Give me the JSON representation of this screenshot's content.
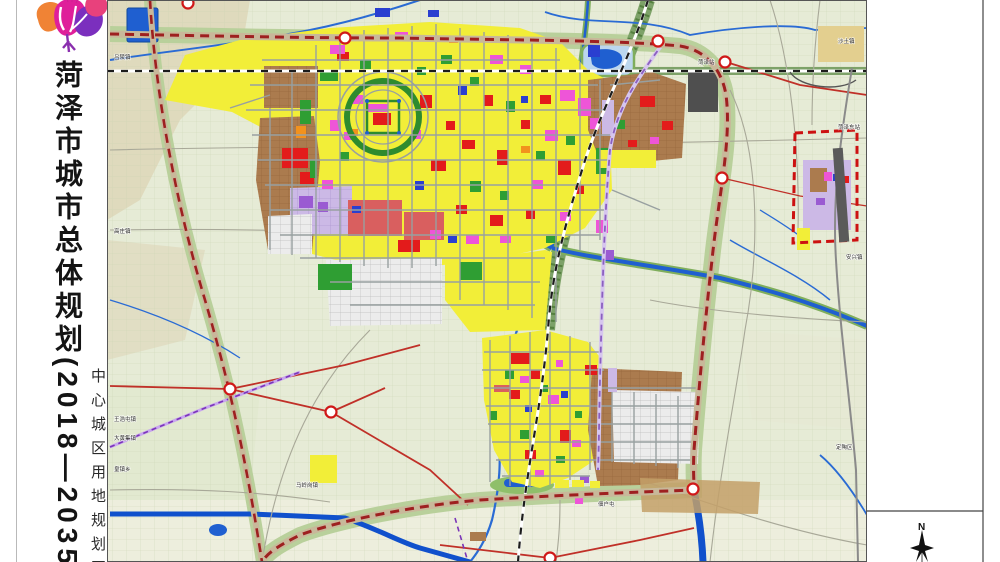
{
  "sidebar": {
    "title": "菏泽市城市总体规划(2018—2035年)",
    "subtitle": "中心城区用地规划图"
  },
  "compass": {
    "north_label": "N"
  },
  "map": {
    "palette": {
      "y": "#f2ee38",
      "r": "#e31b1b",
      "m": "#ee55d8",
      "g": "#2f9e33",
      "b": "#2a3fd0",
      "o": "#f2921d",
      "p": "#9a5bd2",
      "lv": "#ccb9e6",
      "br": "#ab7b4e",
      "dr": "#d95f5f",
      "tn": "#e3cf8f",
      "dg": "#4f4f4f",
      "water": "#1f5fd0",
      "background_field": "#e6ebd6",
      "greenbelt": "#b9d09b",
      "boundary_dash": "#c01414",
      "expressway_dash": "#9e2020",
      "rail_corridor": "#6f9c55"
    },
    "labels": [
      {
        "x": 114,
        "y": 59,
        "t": "吕陵镇"
      },
      {
        "x": 114,
        "y": 233,
        "t": "高庄镇"
      },
      {
        "x": 114,
        "y": 421,
        "t": "王浩屯镇"
      },
      {
        "x": 114,
        "y": 440,
        "t": "大黄集镇"
      },
      {
        "x": 114,
        "y": 471,
        "t": "皇镇乡"
      },
      {
        "x": 296,
        "y": 487,
        "t": "马岭岗镇"
      },
      {
        "x": 698,
        "y": 64,
        "t": "菏泽站"
      },
      {
        "x": 838,
        "y": 129,
        "t": "菏泽东站"
      },
      {
        "x": 838,
        "y": 43,
        "t": "沙土镇"
      },
      {
        "x": 846,
        "y": 259,
        "t": "安兴镇"
      },
      {
        "x": 836,
        "y": 449,
        "t": "定陶区"
      },
      {
        "x": 598,
        "y": 506,
        "t": "佃户屯"
      }
    ],
    "parcels": [
      [
        282,
        148,
        26,
        20,
        "r"
      ],
      [
        300,
        172,
        14,
        12,
        "r"
      ],
      [
        337,
        52,
        12,
        9,
        "r"
      ],
      [
        420,
        95,
        12,
        13,
        "r"
      ],
      [
        446,
        121,
        9,
        9,
        "r"
      ],
      [
        462,
        140,
        13,
        9,
        "r"
      ],
      [
        484,
        95,
        9,
        11,
        "r"
      ],
      [
        497,
        150,
        11,
        15,
        "r"
      ],
      [
        521,
        120,
        9,
        9,
        "r"
      ],
      [
        540,
        95,
        11,
        9,
        "r"
      ],
      [
        431,
        160,
        15,
        11,
        "r"
      ],
      [
        456,
        205,
        11,
        9,
        "r"
      ],
      [
        490,
        215,
        13,
        11,
        "r"
      ],
      [
        526,
        210,
        9,
        9,
        "r"
      ],
      [
        558,
        160,
        13,
        15,
        "r"
      ],
      [
        575,
        185,
        9,
        9,
        "r"
      ],
      [
        373,
        113,
        18,
        12,
        "r"
      ],
      [
        398,
        240,
        22,
        12,
        "r"
      ],
      [
        348,
        200,
        54,
        36,
        "dr"
      ],
      [
        404,
        212,
        40,
        28,
        "dr"
      ],
      [
        330,
        45,
        15,
        9,
        "m"
      ],
      [
        395,
        32,
        13,
        9,
        "m"
      ],
      [
        352,
        95,
        11,
        9,
        "m"
      ],
      [
        330,
        120,
        11,
        11,
        "m"
      ],
      [
        412,
        130,
        9,
        9,
        "m"
      ],
      [
        368,
        104,
        20,
        8,
        "m"
      ],
      [
        322,
        180,
        11,
        9,
        "m"
      ],
      [
        430,
        230,
        11,
        9,
        "m"
      ],
      [
        466,
        235,
        13,
        9,
        "m"
      ],
      [
        500,
        236,
        11,
        7,
        "m"
      ],
      [
        560,
        90,
        15,
        11,
        "m"
      ],
      [
        578,
        98,
        13,
        18,
        "m"
      ],
      [
        590,
        118,
        11,
        11,
        "m"
      ],
      [
        545,
        130,
        13,
        11,
        "m"
      ],
      [
        520,
        65,
        11,
        9,
        "m"
      ],
      [
        490,
        55,
        13,
        9,
        "m"
      ],
      [
        532,
        180,
        11,
        9,
        "m"
      ],
      [
        560,
        212,
        11,
        9,
        "m"
      ],
      [
        596,
        220,
        12,
        13,
        "m"
      ],
      [
        344,
        132,
        10,
        8,
        "m"
      ],
      [
        320,
        70,
        18,
        11,
        "g"
      ],
      [
        360,
        60,
        11,
        9,
        "g"
      ],
      [
        300,
        100,
        11,
        24,
        "g"
      ],
      [
        340,
        152,
        9,
        9,
        "g"
      ],
      [
        441,
        55,
        11,
        9,
        "g"
      ],
      [
        470,
        77,
        9,
        9,
        "g"
      ],
      [
        506,
        101,
        9,
        11,
        "g"
      ],
      [
        536,
        151,
        9,
        9,
        "g"
      ],
      [
        566,
        136,
        9,
        9,
        "g"
      ],
      [
        470,
        181,
        11,
        11,
        "g"
      ],
      [
        500,
        191,
        9,
        9,
        "g"
      ],
      [
        546,
        236,
        11,
        7,
        "g"
      ],
      [
        310,
        160,
        7,
        18,
        "g"
      ],
      [
        596,
        148,
        13,
        26,
        "g"
      ],
      [
        417,
        67,
        9,
        8,
        "g"
      ],
      [
        318,
        264,
        34,
        26,
        "g"
      ],
      [
        460,
        262,
        22,
        18,
        "g"
      ],
      [
        375,
        8,
        15,
        9,
        "b"
      ],
      [
        428,
        10,
        11,
        7,
        "b"
      ],
      [
        458,
        86,
        9,
        9,
        "b"
      ],
      [
        415,
        181,
        9,
        9,
        "b"
      ],
      [
        448,
        236,
        9,
        7,
        "b"
      ],
      [
        352,
        206,
        9,
        7,
        "b"
      ],
      [
        521,
        96,
        7,
        7,
        "b"
      ],
      [
        588,
        42,
        12,
        15,
        "b"
      ],
      [
        349,
        129,
        9,
        7,
        "o"
      ],
      [
        521,
        146,
        9,
        7,
        "o"
      ],
      [
        449,
        36,
        9,
        7,
        "o"
      ],
      [
        296,
        126,
        10,
        12,
        "o"
      ],
      [
        299,
        196,
        14,
        12,
        "p"
      ],
      [
        318,
        202,
        10,
        10,
        "p"
      ],
      [
        602,
        100,
        12,
        36,
        "lv"
      ],
      [
        604,
        250,
        10,
        10,
        "p"
      ],
      [
        511,
        353,
        19,
        11,
        "r"
      ],
      [
        531,
        370,
        9,
        9,
        "r"
      ],
      [
        509,
        390,
        11,
        9,
        "r"
      ],
      [
        560,
        430,
        11,
        13,
        "r"
      ],
      [
        525,
        450,
        11,
        9,
        "r"
      ],
      [
        585,
        365,
        12,
        10,
        "r"
      ],
      [
        548,
        395,
        11,
        9,
        "m"
      ],
      [
        520,
        376,
        9,
        7,
        "m"
      ],
      [
        572,
        440,
        9,
        7,
        "m"
      ],
      [
        535,
        470,
        9,
        7,
        "m"
      ],
      [
        556,
        360,
        7,
        7,
        "m"
      ],
      [
        505,
        370,
        9,
        9,
        "g"
      ],
      [
        541,
        385,
        7,
        7,
        "g"
      ],
      [
        520,
        430,
        9,
        9,
        "g"
      ],
      [
        556,
        456,
        9,
        7,
        "g"
      ],
      [
        490,
        411,
        7,
        9,
        "g"
      ],
      [
        575,
        411,
        7,
        7,
        "g"
      ],
      [
        525,
        405,
        7,
        7,
        "b"
      ],
      [
        561,
        391,
        7,
        7,
        "b"
      ],
      [
        608,
        368,
        9,
        24,
        "lv"
      ],
      [
        580,
        476,
        9,
        7,
        "p"
      ],
      [
        494,
        385,
        16,
        7,
        "dr"
      ],
      [
        640,
        96,
        15,
        11,
        "r"
      ],
      [
        662,
        121,
        11,
        9,
        "r"
      ],
      [
        628,
        140,
        9,
        7,
        "r"
      ],
      [
        650,
        137,
        9,
        7,
        "m"
      ],
      [
        616,
        120,
        9,
        9,
        "g"
      ],
      [
        600,
        150,
        56,
        18,
        "y"
      ],
      [
        803,
        160,
        48,
        70,
        "lv"
      ],
      [
        810,
        168,
        17,
        24,
        "br"
      ],
      [
        824,
        172,
        8,
        9,
        "m"
      ],
      [
        833,
        174,
        7,
        7,
        "b"
      ],
      [
        841,
        176,
        8,
        7,
        "r"
      ],
      [
        816,
        198,
        9,
        7,
        "p"
      ],
      [
        797,
        228,
        13,
        22,
        "y"
      ],
      [
        818,
        26,
        46,
        36,
        "tn"
      ],
      [
        310,
        455,
        27,
        28,
        "y"
      ],
      [
        555,
        480,
        14,
        8,
        "y"
      ],
      [
        572,
        480,
        12,
        7,
        "y"
      ],
      [
        590,
        481,
        10,
        7,
        "y"
      ],
      [
        470,
        532,
        16,
        9,
        "br"
      ],
      [
        575,
        497,
        8,
        7,
        "m"
      ],
      [
        688,
        72,
        30,
        40,
        "dg"
      ]
    ]
  }
}
